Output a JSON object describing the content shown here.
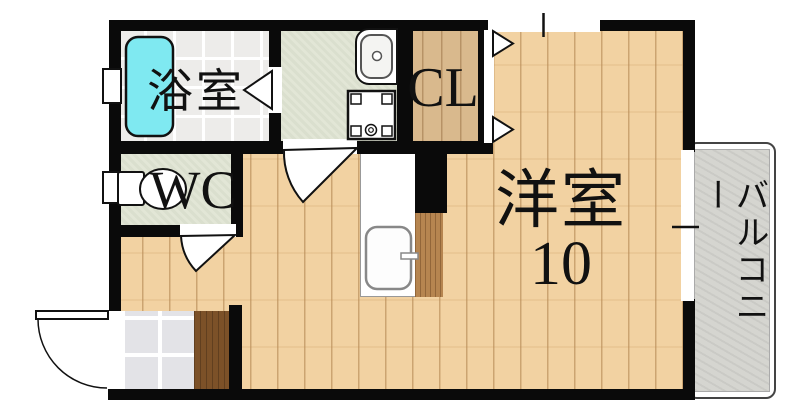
{
  "plan": {
    "type": "apartment-floor-plan",
    "rooms": {
      "bathroom": {
        "label": "浴室"
      },
      "wc": {
        "label": "WC"
      },
      "closet": {
        "label": "CL"
      },
      "main_room": {
        "label": "洋室",
        "size": "10"
      },
      "balcony": {
        "label": "バルコニー"
      }
    },
    "fixtures": [
      "bathtub",
      "toilet",
      "vanity-sink",
      "washing-machine-pan",
      "kitchen-sink",
      "kitchen-counter",
      "entry-step"
    ],
    "openings": [
      "entrance-door",
      "bathroom-folding-door",
      "washroom-door",
      "wc-door",
      "closet-bifold-door",
      "top-window",
      "right-window",
      "bathroom-window",
      "wc-window"
    ],
    "colors": {
      "wall": "#0a0a0a",
      "bathtub": "#7fe9f1",
      "wood_floor": "#f2d2a2",
      "closet_wood": "#d9b98d",
      "wet_room_floor": "#e2e6d6",
      "bathroom_tile": "#edecea",
      "entry_tile": "#e3e3e7",
      "entry_step": "#7c5128",
      "kitchen_counter_wood": "#b68550",
      "balcony_floor": "#d5d5d0"
    }
  }
}
